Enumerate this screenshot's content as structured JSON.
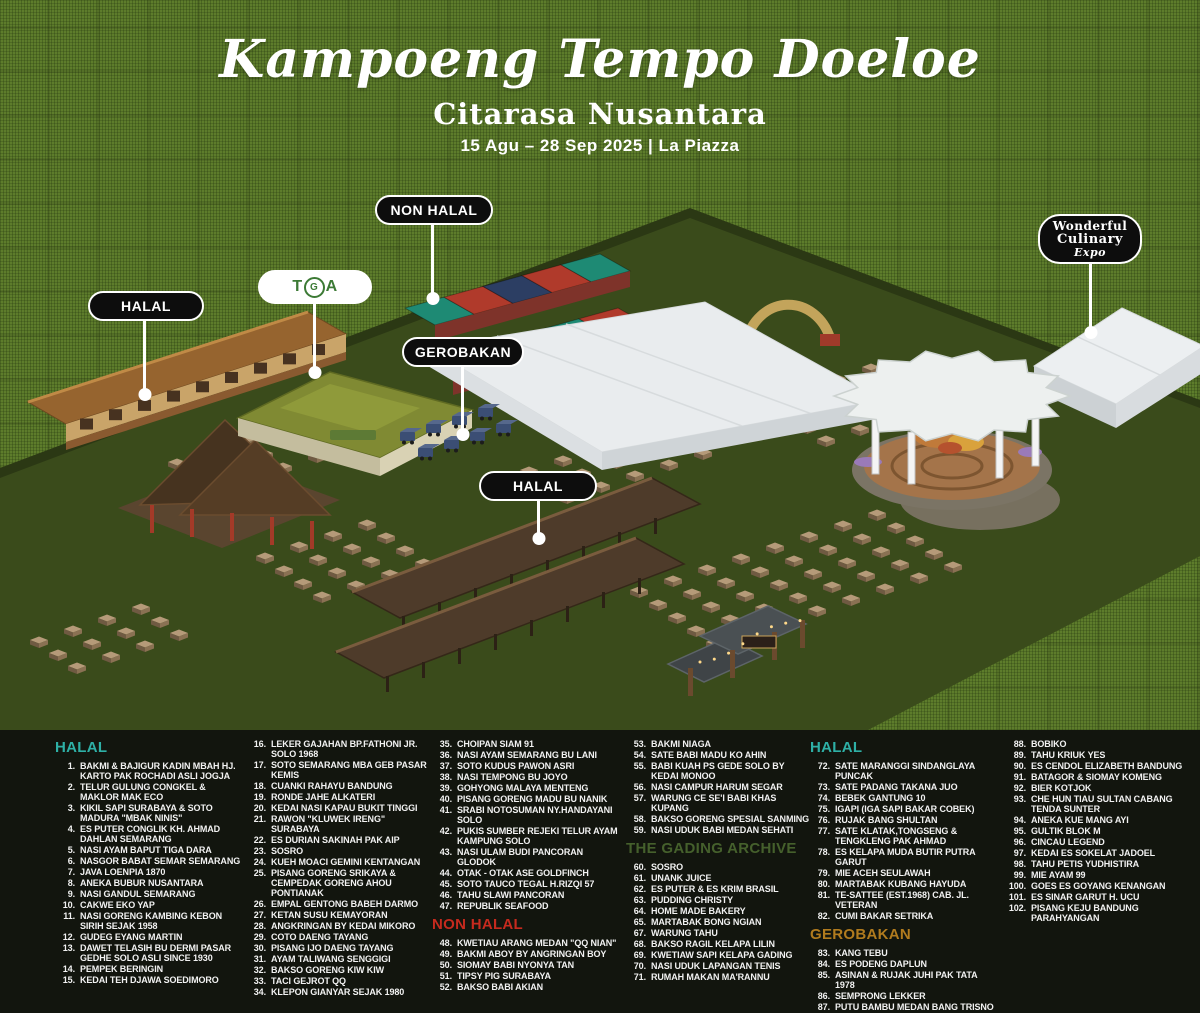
{
  "title": {
    "main": "Kampoeng Tempo Doeloe",
    "sub": "Citarasa Nusantara",
    "date": "15 Agu – 28 Sep 2025 | La Piazza"
  },
  "map": {
    "pills": {
      "halal_left": "HALAL",
      "non_halal": "NON HALAL",
      "gerobakan": "GEROBAKAN",
      "halal_bottom": "HALAL"
    },
    "tga": {
      "t": "T",
      "g": "G",
      "a": "A"
    },
    "wce": {
      "line1": "Wonderful",
      "line2": "Culinary",
      "line3": "Expo"
    }
  },
  "colors": {
    "halal": "#2eb0a6",
    "nonhalal": "#c62a1e",
    "archive": "#45602c",
    "gerobakan": "#b17b1e"
  },
  "legend": {
    "columns": [
      {
        "blocks": [
          {
            "header": "HALAL",
            "color": "halal",
            "items": [
              [
                "1.",
                "BAKMI & BAJIGUR KADIN MBAH HJ. KARTO PAK ROCHADI ASLI JOGJA"
              ],
              [
                "2.",
                "TELUR GULUNG CONGKEL & MAKLOR MAK ECO"
              ],
              [
                "3.",
                "KIKIL SAPI SURABAYA & SOTO MADURA \"MBAK NINIS\""
              ],
              [
                "4.",
                "ES PUTER CONGLIK KH. AHMAD DAHLAN SEMARANG"
              ],
              [
                "5.",
                "NASI AYAM BAPUT TIGA DARA"
              ],
              [
                "6.",
                "NASGOR BABAT SEMAR SEMARANG"
              ],
              [
                "7.",
                "JAVA LOENPIA 1870"
              ],
              [
                "8.",
                "ANEKA BUBUR NUSANTARA"
              ],
              [
                "9.",
                "NASI GANDUL SEMARANG"
              ],
              [
                "10.",
                "CAKWE EKO YAP"
              ],
              [
                "11.",
                "NASI GORENG KAMBING KEBON SIRIH SEJAK 1958"
              ],
              [
                "12.",
                "GUDEG EYANG MARTIN"
              ],
              [
                "13.",
                "DAWET TELASIH BU DERMI PASAR GEDHE SOLO ASLI SINCE 1930"
              ],
              [
                "14.",
                "PEMPEK BERINGIN"
              ],
              [
                "15.",
                "KEDAI TEH DJAWA SOEDIMORO"
              ]
            ]
          }
        ]
      },
      {
        "blocks": [
          {
            "header": null,
            "items": [
              [
                "16.",
                "LEKER GAJAHAN BP.FATHONI JR. SOLO 1968"
              ],
              [
                "17.",
                "SOTO SEMARANG MBA GEB PASAR KEMIS"
              ],
              [
                "18.",
                "CUANKI RAHAYU BANDUNG"
              ],
              [
                "19.",
                "RONDE JAHE ALKATERI"
              ],
              [
                "20.",
                "KEDAI NASI KAPAU BUKIT TINGGI"
              ],
              [
                "21.",
                "RAWON \"KLUWEK IRENG\" SURABAYA"
              ],
              [
                "22.",
                "ES DURIAN SAKINAH PAK AIP"
              ],
              [
                "23.",
                "SOSRO"
              ],
              [
                "24.",
                "KUEH MOACI GEMINI KENTANGAN"
              ],
              [
                "25.",
                "PISANG GORENG SRIKAYA & CEMPEDAK GORENG AHOU PONTIANAK"
              ],
              [
                "26.",
                "EMPAL GENTONG BABEH DARMO"
              ],
              [
                "27.",
                "KETAN SUSU KEMAYORAN"
              ],
              [
                "28.",
                "ANGKRINGAN BY KEDAI MIKORO"
              ],
              [
                "29.",
                "COTO DAENG TAYANG"
              ],
              [
                "30.",
                "PISANG IJO DAENG TAYANG"
              ],
              [
                "31.",
                "AYAM TALIWANG SENGGIGI"
              ],
              [
                "32.",
                "BAKSO GORENG KIW KIW"
              ],
              [
                "33.",
                "TACI GEJROT QQ"
              ],
              [
                "34.",
                "KLEPON GIANYAR SEJAK 1980"
              ]
            ]
          }
        ]
      },
      {
        "blocks": [
          {
            "header": null,
            "items": [
              [
                "35.",
                "CHOIPAN SIAM 91"
              ],
              [
                "36.",
                "NASI AYAM SEMARANG BU LANI"
              ],
              [
                "37.",
                "SOTO KUDUS PAWON ASRI"
              ],
              [
                "38.",
                "NASI TEMPONG BU JOYO"
              ],
              [
                "39.",
                "GOHYONG MALAYA MENTENG"
              ],
              [
                "40.",
                "PISANG GORENG MADU BU NANIK"
              ],
              [
                "41.",
                "SRABI NOTOSUMAN NY.HANDAYANI SOLO"
              ],
              [
                "42.",
                "PUKIS SUMBER REJEKI TELUR AYAM KAMPUNG SOLO"
              ],
              [
                "43.",
                "NASI ULAM BUDI PANCORAN GLODOK"
              ],
              [
                "44.",
                "OTAK - OTAK ASE GOLDFINCH"
              ],
              [
                "45.",
                "SOTO TAUCO TEGAL H.RIZQI 57"
              ],
              [
                "46.",
                "TAHU SLAWI PANCORAN"
              ],
              [
                "47.",
                "REPUBLIK SEAFOOD"
              ]
            ]
          },
          {
            "header": "NON HALAL",
            "color": "nonhalal",
            "items": [
              [
                "48.",
                "KWETIAU ARANG MEDAN \"QQ NIAN\""
              ],
              [
                "49.",
                "BAKMI ABOY BY ANGRINGAN BOY"
              ],
              [
                "50.",
                "SIOMAY BABI NYONYA TAN"
              ],
              [
                "51.",
                "TIPSY PIG SURABAYA"
              ],
              [
                "52.",
                "BAKSO BABI AKIAN"
              ]
            ]
          }
        ]
      },
      {
        "blocks": [
          {
            "header": null,
            "items": [
              [
                "53.",
                "BAKMI NIAGA"
              ],
              [
                "54.",
                "SATE BABI MADU KO AHIN"
              ],
              [
                "55.",
                "BABI KUAH PS GEDE SOLO BY KEDAI MONOO"
              ],
              [
                "56.",
                "NASI CAMPUR HARUM SEGAR"
              ],
              [
                "57.",
                "WARUNG CE SE'I BABI KHAS KUPANG"
              ],
              [
                "58.",
                "BAKSO GORENG SPESIAL SANMING"
              ],
              [
                "59.",
                "NASI UDUK BABI MEDAN SEHATI"
              ]
            ]
          },
          {
            "header": "THE GADING ARCHIVE",
            "color": "archive",
            "items": [
              [
                "60.",
                "SOSRO"
              ],
              [
                "61.",
                "UNANK JUICE"
              ],
              [
                "62.",
                "ES PUTER & ES KRIM BRASIL"
              ],
              [
                "63.",
                "PUDDING CHRISTY"
              ],
              [
                "64.",
                "HOME MADE BAKERY"
              ],
              [
                "65.",
                "MARTABAK BONG NGIAN"
              ],
              [
                "67.",
                "WARUNG TAHU"
              ],
              [
                "68.",
                "BAKSO RAGIL KELAPA LILIN"
              ],
              [
                "69.",
                "KWETIAW SAPI KELAPA GADING"
              ],
              [
                "70.",
                "NASI UDUK LAPANGAN TENIS"
              ],
              [
                "71.",
                "RUMAH MAKAN MA'RANNU"
              ]
            ]
          }
        ]
      },
      {
        "blocks": [
          {
            "header": "HALAL",
            "color": "halal",
            "items": [
              [
                "72.",
                "SATE MARANGGI SINDANGLAYA PUNCAK"
              ],
              [
                "73.",
                "SATE PADANG TAKANA JUO"
              ],
              [
                "74.",
                "BEBEK GANTUNG 10"
              ],
              [
                "75.",
                "IGAPI (IGA SAPI BAKAR COBEK)"
              ],
              [
                "76.",
                "RUJAK BANG SHULTAN"
              ],
              [
                "77.",
                "SATE KLATAK,TONGSENG & TENGKLENG PAK AHMAD"
              ],
              [
                "78.",
                "ES KELAPA MUDA BUTIR PUTRA GARUT"
              ],
              [
                "79.",
                "MIE ACEH SEULAWAH"
              ],
              [
                "80.",
                "MARTABAK KUBANG HAYUDA"
              ],
              [
                "81.",
                "TE-SATTEE (EST.1968) CAB. JL. VETERAN"
              ],
              [
                "82.",
                "CUMI BAKAR SETRIKA"
              ]
            ]
          },
          {
            "header": "GEROBAKAN",
            "color": "gerobakan",
            "items": [
              [
                "83.",
                "KANG TEBU"
              ],
              [
                "84.",
                "ES PODENG DAPLUN"
              ],
              [
                "85.",
                "ASINAN & RUJAK JUHI PAK TATA 1978"
              ],
              [
                "86.",
                "SEMPRONG LEKKER"
              ],
              [
                "87.",
                "PUTU BAMBU MEDAN BANG TRISNO"
              ]
            ]
          }
        ]
      },
      {
        "blocks": [
          {
            "header": null,
            "items": [
              [
                "88.",
                "BOBIKO"
              ],
              [
                "89.",
                "TAHU KRIUK YES"
              ],
              [
                "90.",
                "ES CENDOL ELIZABETH BANDUNG"
              ],
              [
                "91.",
                "BATAGOR & SIOMAY KOMENG"
              ],
              [
                "92.",
                "BIER KOTJOK"
              ],
              [
                "93.",
                "CHE HUN TIAU SULTAN CABANG TENDA SUNTER"
              ],
              [
                "94.",
                "ANEKA KUE MANG AYI"
              ],
              [
                "95.",
                "GULTIK BLOK M"
              ],
              [
                "96.",
                "CINCAU LEGEND"
              ],
              [
                "97.",
                "KEDAI ES SOKELAT JADOEL"
              ],
              [
                "98.",
                "TAHU PETIS YUDHISTIRA"
              ],
              [
                "99.",
                "MIE AYAM 99"
              ],
              [
                "100.",
                "GOES ES GOYANG KENANGAN"
              ],
              [
                "101.",
                "ES SINAR GARUT H. UCU"
              ],
              [
                "102.",
                "PISANG KEJU BANDUNG PARAHYANGAN"
              ]
            ]
          }
        ]
      }
    ]
  }
}
